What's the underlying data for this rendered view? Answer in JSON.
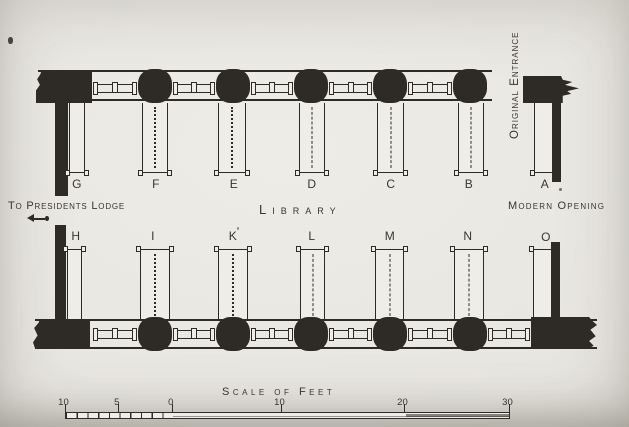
{
  "colors": {
    "ink": "#2e2a25",
    "paper": "#eae8e2"
  },
  "plan": {
    "room_label": "Library",
    "top_row_labels": [
      "G",
      "F",
      "E",
      "D",
      "C",
      "B",
      "A"
    ],
    "bottom_row_labels": [
      "H",
      "I",
      "K",
      "L",
      "M",
      "N",
      "O"
    ],
    "annotations": {
      "west_passage": "To Presidents Lodge",
      "north_east_entrance": "Original Entrance",
      "south_east_opening": "Modern Opening"
    }
  },
  "scale_bar": {
    "title": "Scale of Feet",
    "tick_labels": [
      "10",
      "5",
      "0",
      "10",
      "20",
      "30"
    ]
  }
}
